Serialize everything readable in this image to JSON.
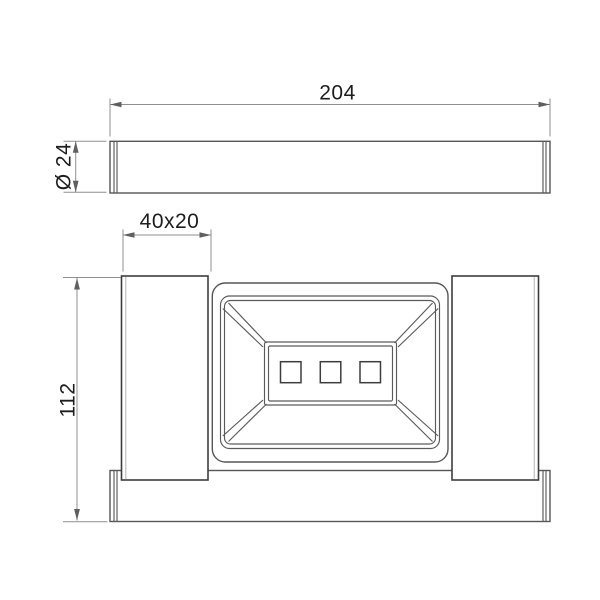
{
  "drawing": {
    "type": "technical-dimension-diagram",
    "subject": "wall-mounted soap dish holder with bar, two orthographic views",
    "dimensions": {
      "bar_length": "204",
      "bar_diameter": "Ø 24",
      "post_section": "40x20",
      "overall_height": "112"
    },
    "colors": {
      "background": "#ffffff",
      "object_line": "#4a4a4a",
      "dimension_line": "#8f8f8f",
      "text": "#1d1d1d"
    }
  }
}
